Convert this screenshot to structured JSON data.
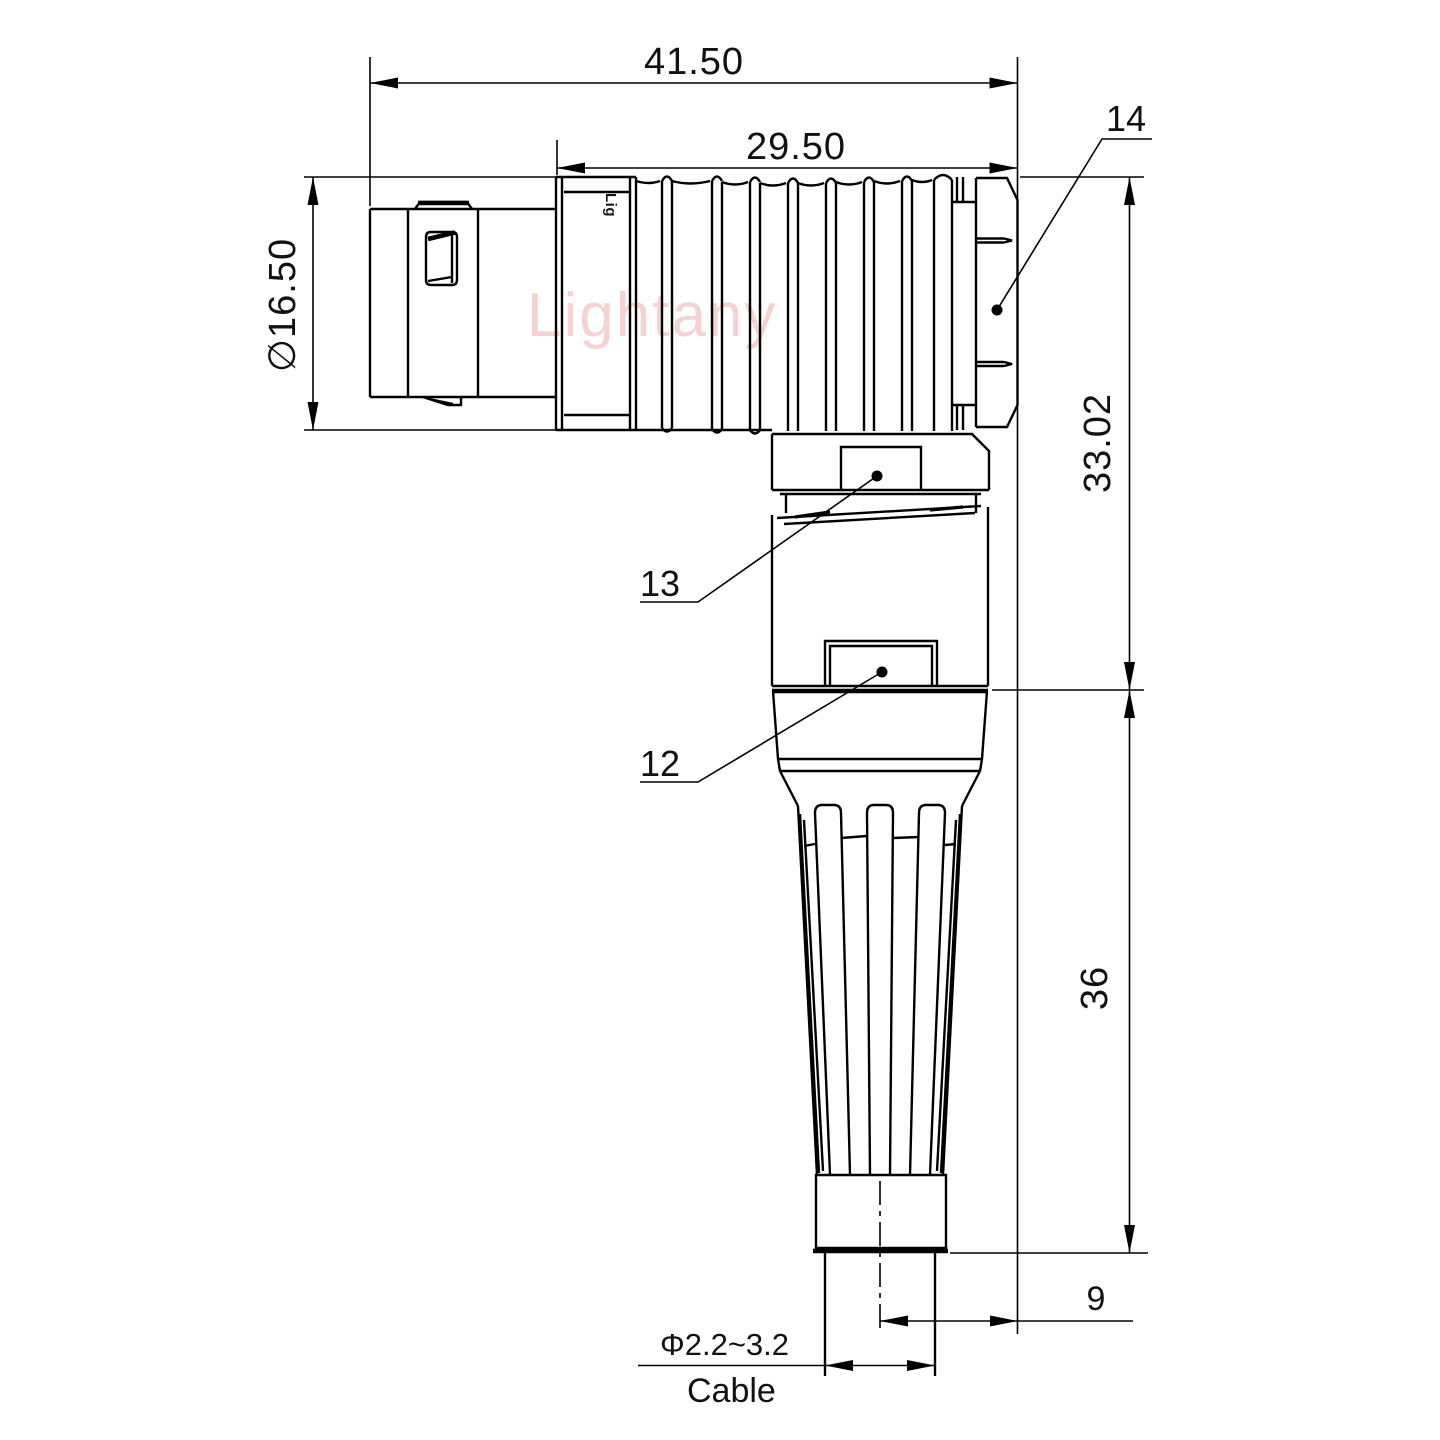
{
  "drawing": {
    "watermark": "Lightany",
    "shell_logo": "Lig",
    "dims": {
      "overall_length": "41.50",
      "rear_length": "29.50",
      "shell_diameter": "∅16.50",
      "elbow_height": "33.02",
      "boot_height": "36",
      "axis_offset": "9",
      "cable_range": "Φ2.2~3.2",
      "cable_label": "Cable"
    },
    "labels": {
      "back_nut": "14",
      "collar_detent": "13",
      "sleeve_detent": "12"
    },
    "colors": {
      "line": "#000000",
      "background": "#ffffff",
      "watermark": "#eda9a9"
    }
  }
}
